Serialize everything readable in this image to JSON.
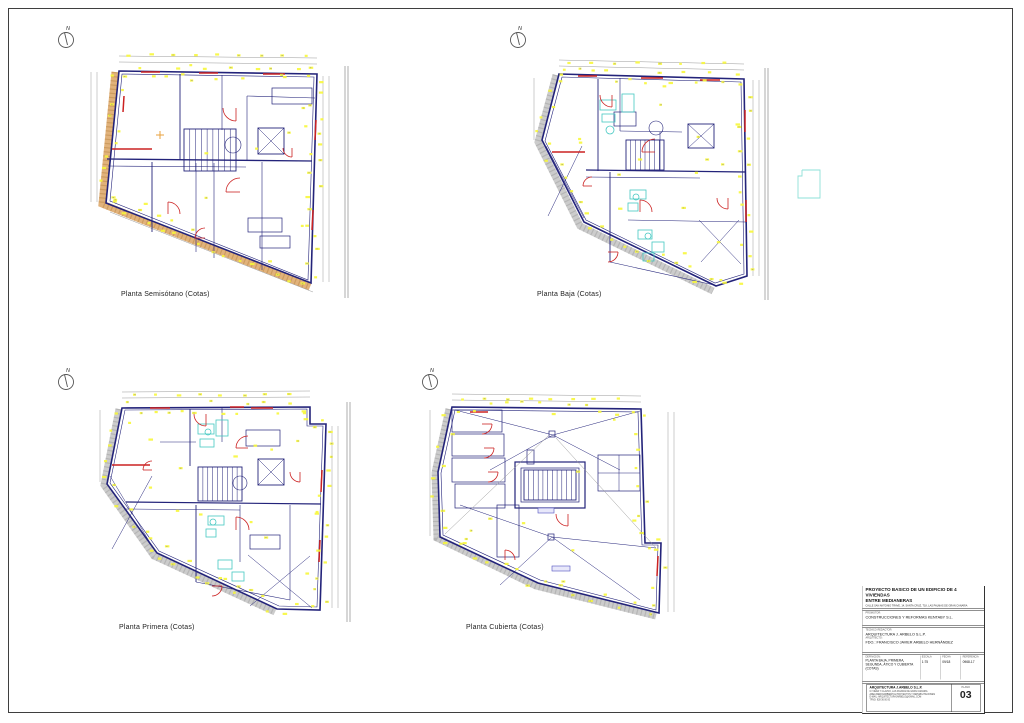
{
  "sheet": {
    "background": "#ffffff",
    "border_color": "#3f3f3f"
  },
  "north_label": "N",
  "plans": [
    {
      "label": "Planta Semisótano (Cotas)"
    },
    {
      "label": "Planta Baja (Cotas)"
    },
    {
      "label": "Planta Primera (Cotas)"
    },
    {
      "label": "Planta Cubierta (Cotas)"
    }
  ],
  "title_block": {
    "project_title_line1": "PROYECTO BASICO DE UN EDIFICIO DE 4 VIVIENDAS",
    "project_title_line2": "ENTRE MEDIANERAS",
    "project_address": "CALLE SAN ANTONIO TRAVE, 14, SANTA CRUZ, T18, LAS PALMAS DE GRAN CANARIA",
    "promoter_label": "PROMOTOR:",
    "promoter": "CONSTRUCCIONES Y REFORMAS KENTABY S.L.",
    "technician_label": "TECNICO REDACTOR:",
    "technician": "ARQUITECTURA J. ARBELO S.L.P.",
    "architect_label": "ARQUITECTO:",
    "architect_signature": "FDO.: FRANCISCO JAVIER ARBELO HERNÁNDEZ",
    "definition_label": "DEFINICION:",
    "definition_line1": "PLANTA BAJA, PRIMERA,",
    "definition_line2": "SEGUNDA, ÁTICO Y CUBIERTA",
    "definition_line3": "(COTAS)",
    "scale_label": "ESCALA",
    "scale": "1:75",
    "date_label": "FECHA",
    "date": "09/18",
    "reference_label": "REFERENCIA",
    "reference": "0968-17",
    "firm_name": "ARQUITECTURA J.ARBELO S.L.P.",
    "firm_line1": "C/ VIERA Y CLAVIJO, LAS PALMAS DE GRAN CANARIA",
    "firm_line2": "AREA MEDIOAMBIENTAL PROYECTOS Y REHABILITACIONES",
    "firm_line3": "E-MAIL: ARQUITECTURAJARBELO@GMAIL.COM",
    "firm_line4": "TFNO: 928 36 00 00",
    "plano_label": "PLANO",
    "plano_number": "03"
  },
  "colors": {
    "wall": "#23237a",
    "red": "#cc2222",
    "yellow": "#f7f73a",
    "cyan": "#45c8c2",
    "blue_label": "#5050c0",
    "hatch_tan": "#dfae74",
    "hatch_tan_dark": "#b5803f",
    "hatch_gray": "#c9c9c9",
    "hatch_gray_dark": "#9a9a9a",
    "dim": "#999999",
    "orange": "#e8a23c"
  }
}
